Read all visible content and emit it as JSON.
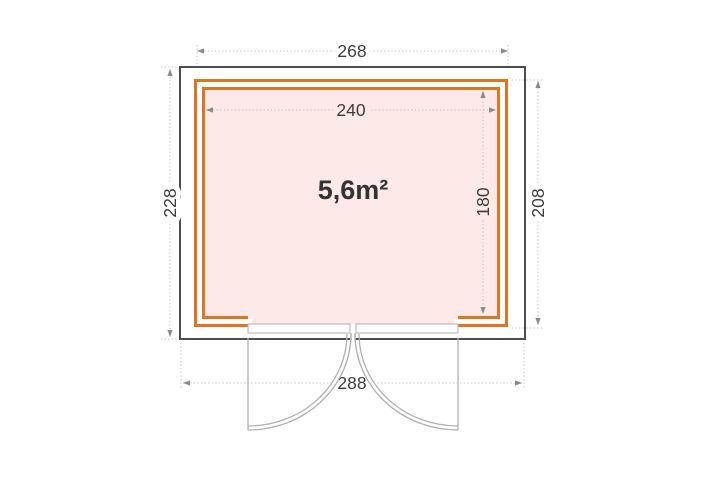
{
  "plan": {
    "area_label": "5,6m²",
    "dim_outer_width": "268",
    "dim_inner_width": "240",
    "dim_roof_depth": "228",
    "dim_inner_depth": "180",
    "dim_outer_depth": "208",
    "dim_roof_width": "288",
    "colors": {
      "wall": "#df7520",
      "floor": "#fce9e8",
      "outline": "#4d4d4d"
    }
  }
}
